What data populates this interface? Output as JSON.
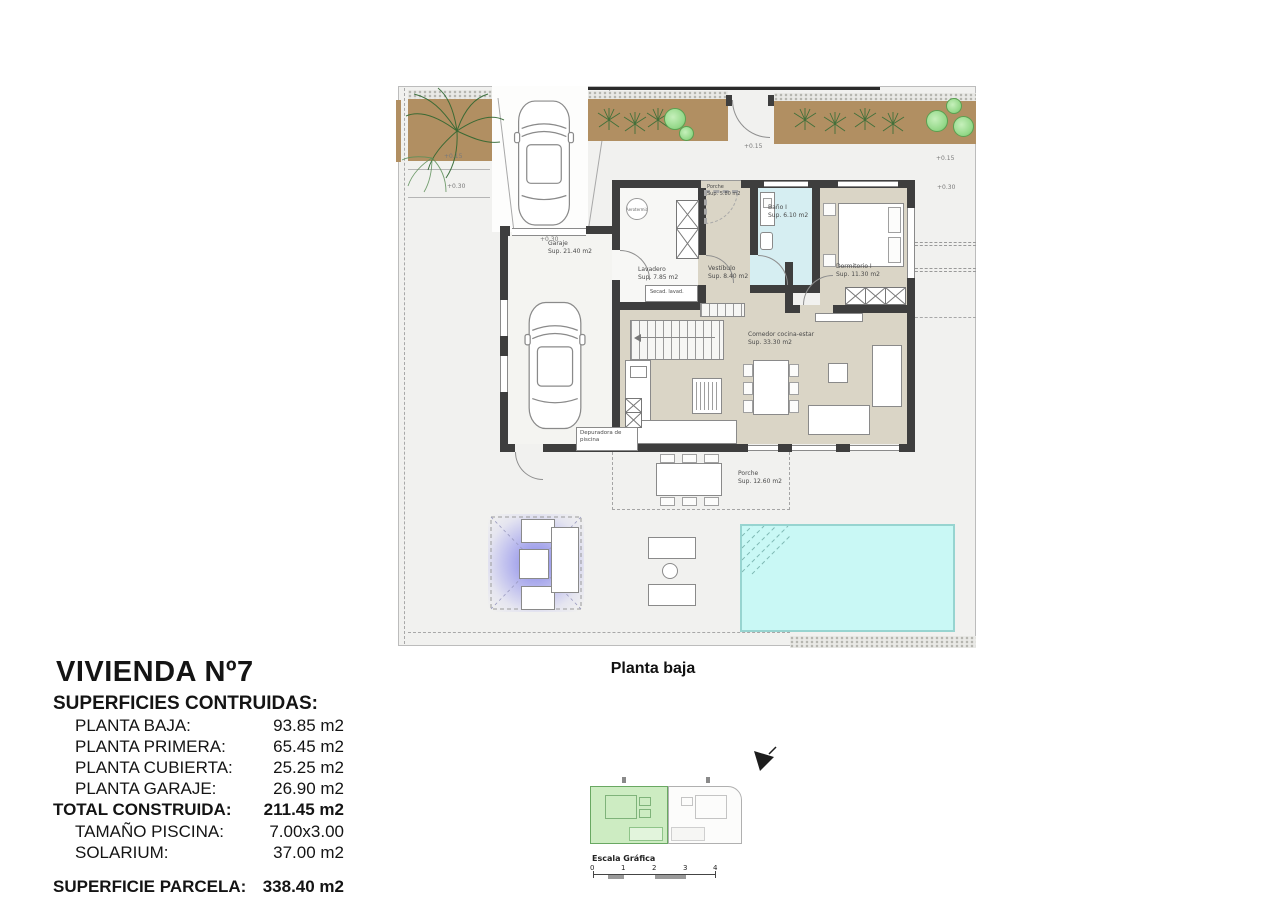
{
  "info_panel": {
    "title": "VIVIENDA Nº7",
    "subtitle": "SUPERFICIES CONTRUIDAS:",
    "rows": [
      {
        "label": "PLANTA BAJA:",
        "value": "93.85 m2"
      },
      {
        "label": "PLANTA PRIMERA:",
        "value": "65.45 m2"
      },
      {
        "label": "PLANTA CUBIERTA:",
        "value": "25.25 m2"
      },
      {
        "label": "PLANTA GARAJE:",
        "value": "26.90 m2"
      }
    ],
    "total_row": {
      "label": "TOTAL CONSTRUIDA:",
      "value": "211.45 m2"
    },
    "extra_rows": [
      {
        "label": "TAMAÑO PISCINA:",
        "value": "7.00x3.00"
      },
      {
        "label": "SOLARIUM:",
        "value": "37.00 m2"
      }
    ],
    "parcel_row": {
      "label": "SUPERFICIE PARCELA:",
      "value": "338.40 m2"
    }
  },
  "plan": {
    "caption": "Planta baja",
    "rooms": [
      {
        "name": "Garaje",
        "area": "Sup. 21.40 m2"
      },
      {
        "name": "Porche",
        "area": "Sup. 5.80 m2"
      },
      {
        "name": "Baño I",
        "area": "Sup. 6.10 m2"
      },
      {
        "name": "Dormitorio I",
        "area": "Sup. 11.30 m2"
      },
      {
        "name": "Vestíbulo",
        "area": "Sup. 8.40 m2"
      },
      {
        "name": "Lavadero",
        "area": "Sup. 7.85 m2"
      },
      {
        "name": "Comedor cocina-estar",
        "area": "Sup. 33.30 m2"
      },
      {
        "name": "Porche",
        "area": "Sup. 12.60 m2"
      }
    ],
    "labels": {
      "aerotermia": "Aerotermia",
      "washer_dryer": "Secad. lavad.",
      "pool_pump": "Depuradora de piscina"
    },
    "levels": [
      "+0.15",
      "+0.30",
      "+0.30",
      "+0.15",
      "+0.15",
      "+0.30"
    ]
  },
  "mini_map": {
    "scale_title": "Escala Gráfica",
    "scale_ticks": [
      "0",
      "1",
      "2",
      "3",
      "4"
    ]
  },
  "colors": {
    "wall": "#3e3e3e",
    "floor_beige": "#dad5c6",
    "bath_blue": "#d6eef2",
    "pool_fill": "#c9f8f5",
    "pool_edge": "#97d4d0",
    "garden_soil": "#b18f62",
    "tree_green": "#94d889",
    "pergola_glow": "#7373e8",
    "highlight_unit_green": "#cdecc2"
  }
}
